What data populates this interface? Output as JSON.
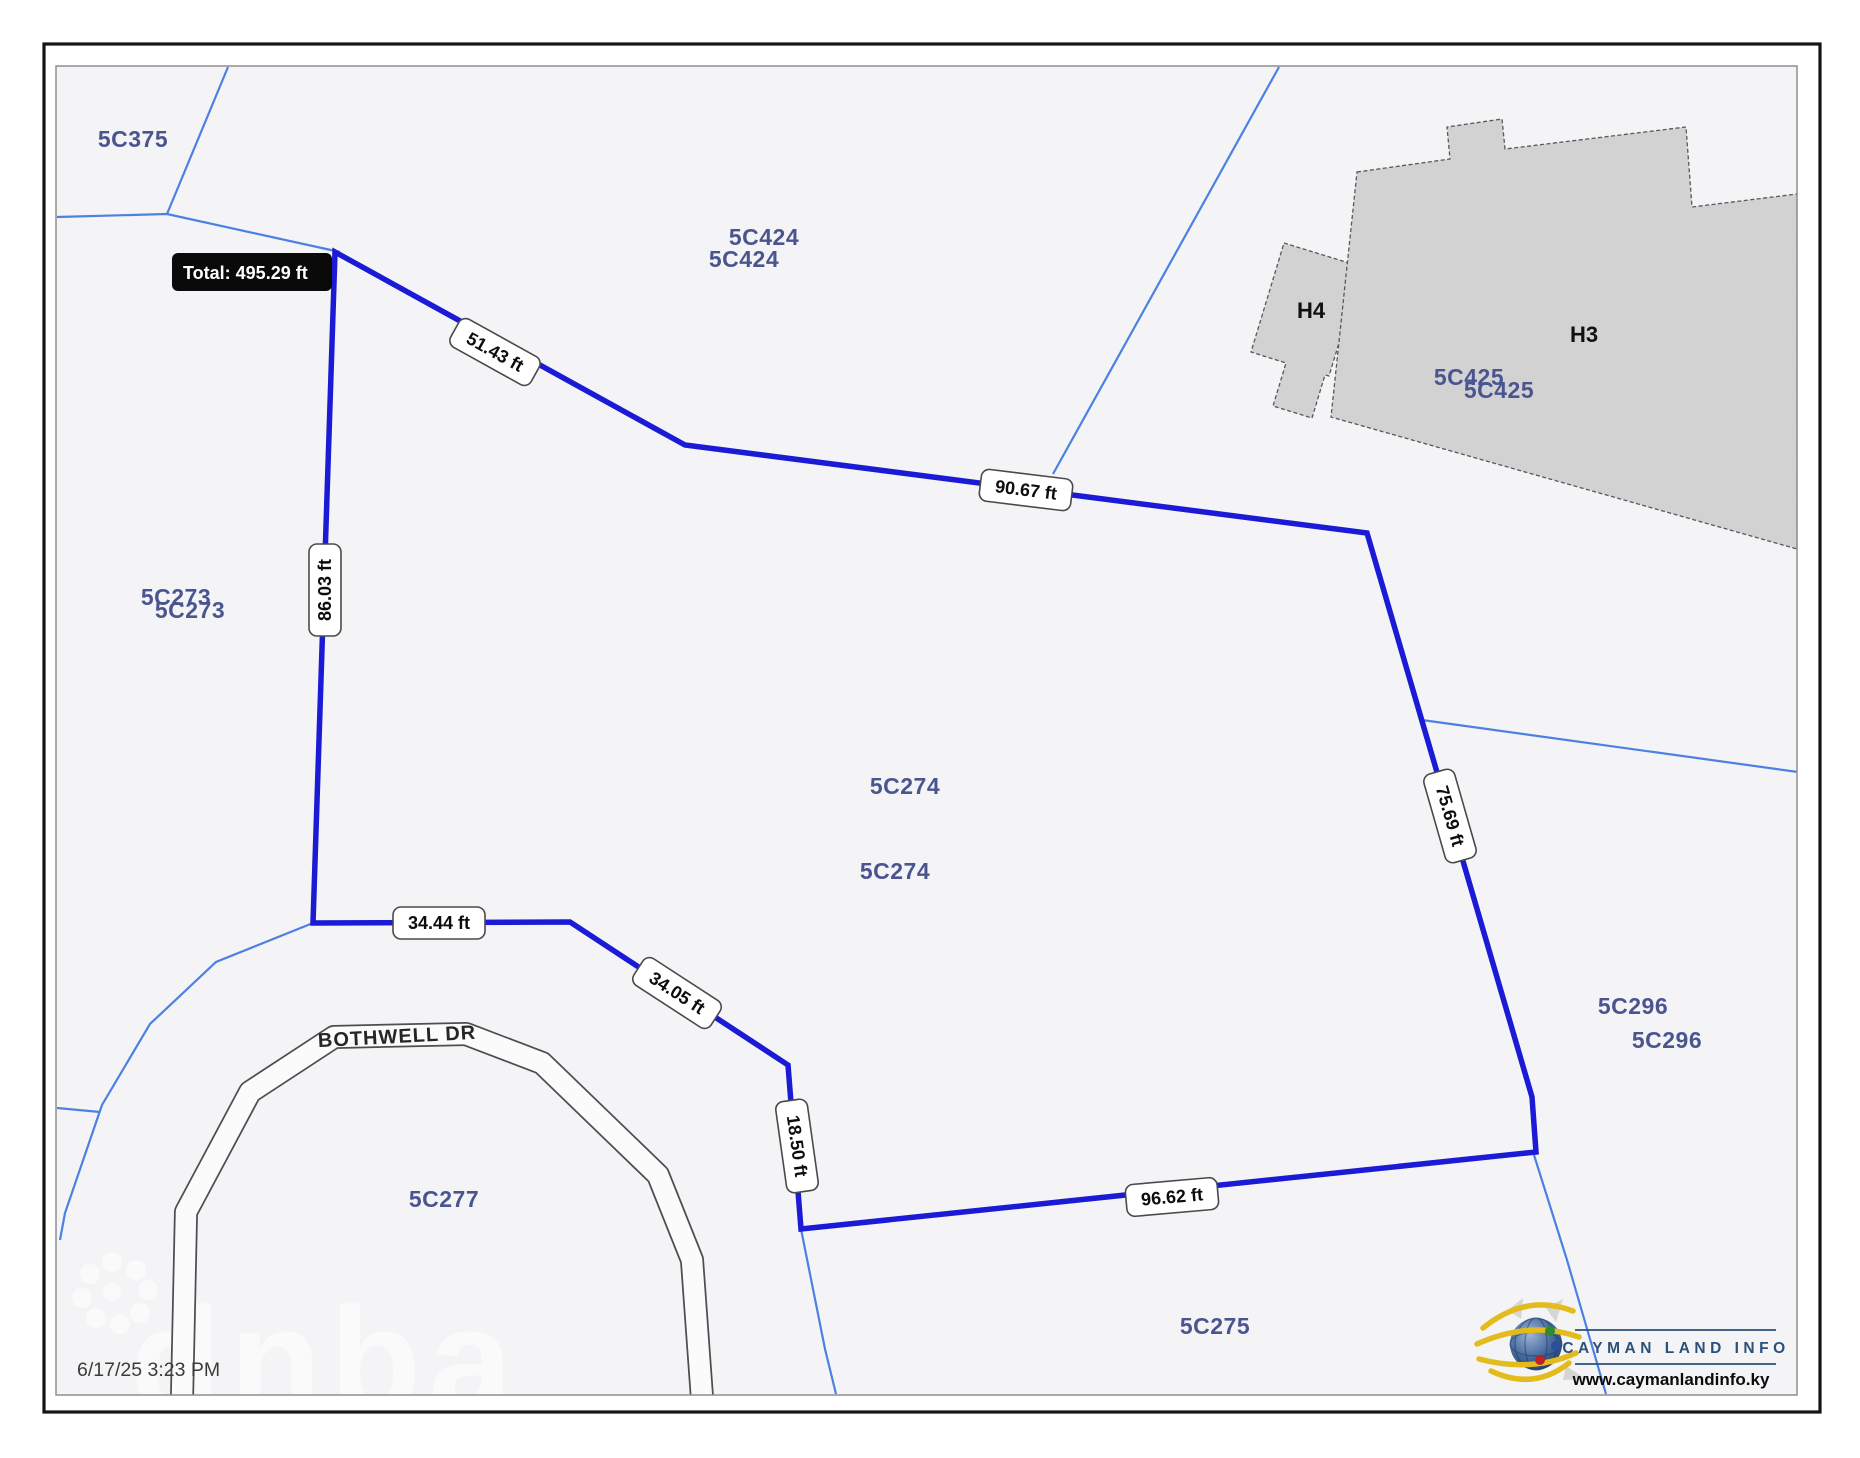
{
  "map": {
    "timestamp": "6/17/25 3:23 PM",
    "road": {
      "name": "BOTHWELL DR"
    },
    "tooltip": {
      "total_label": "Total: 495.29 ft"
    },
    "measurements": {
      "total": "495.29 ft",
      "segments": [
        {
          "label": "51.43 ft"
        },
        {
          "label": "90.67 ft"
        },
        {
          "label": "75.69 ft"
        },
        {
          "label": "96.62 ft"
        },
        {
          "label": "18.50 ft"
        },
        {
          "label": "34.05 ft"
        },
        {
          "label": "34.44 ft"
        },
        {
          "label": "86.03 ft"
        }
      ]
    },
    "parcels": {
      "labels": [
        "5C375",
        "5C424",
        "5C424",
        "5C425",
        "5C425",
        "5C273",
        "5C273",
        "5C274",
        "5C274",
        "5C296",
        "5C296",
        "5C277",
        "5C275"
      ]
    },
    "buildings": [
      {
        "label": "H4"
      },
      {
        "label": "H3"
      }
    ],
    "watermark_text": "dnba",
    "colors": {
      "measure_line": "#1b1bd6",
      "parcel_line": "#4c80e2",
      "parcel_text": "#4a5590",
      "building_fill": "#d2d2d3",
      "tooltip_bg": "#0a0a0a",
      "map_bg": "#f4f4f6",
      "logo_blue": "#2c5179",
      "logo_yellow": "#e3bb1c"
    }
  },
  "logo": {
    "name": "CAYMAN LAND INFO",
    "url": "www.caymanlandinfo.ky"
  }
}
